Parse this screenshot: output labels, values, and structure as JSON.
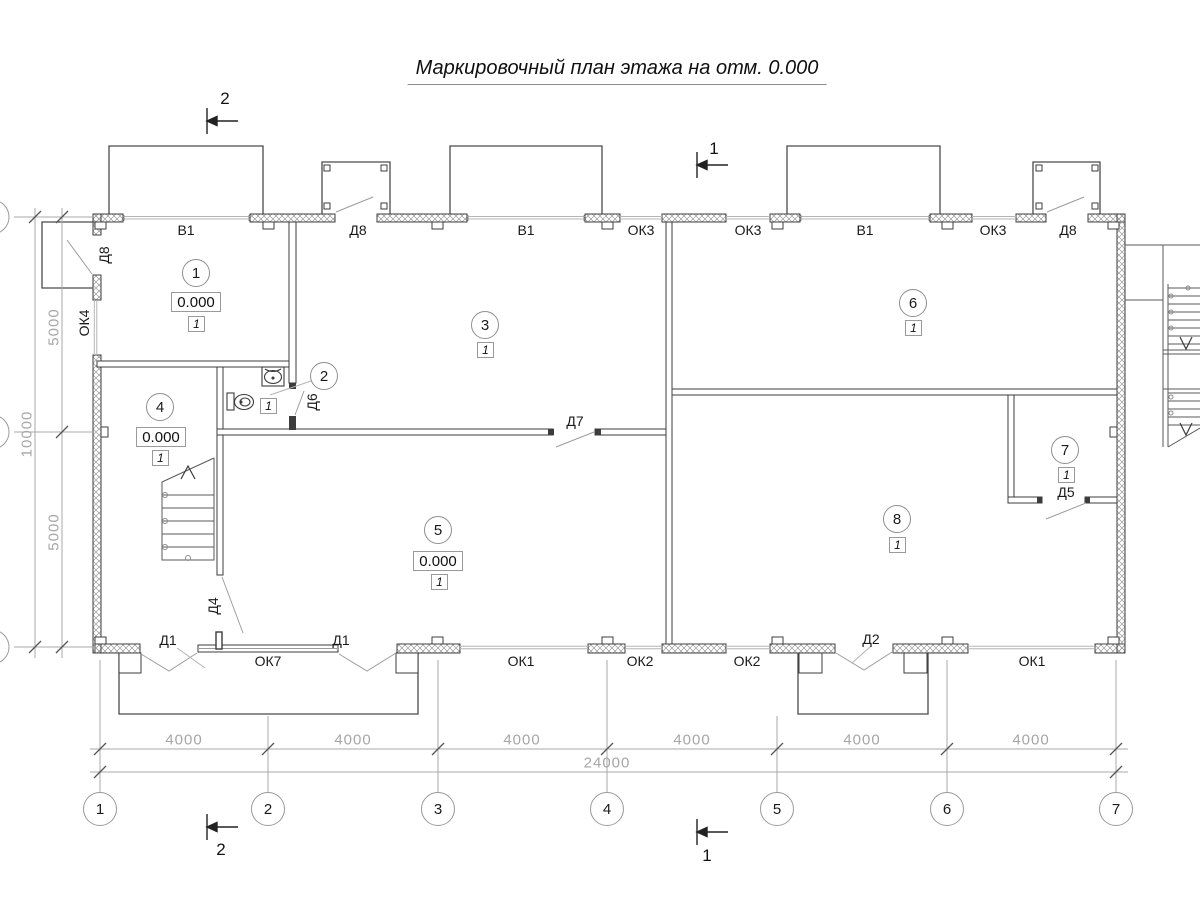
{
  "title": "Маркировочный план этажа на отм. 0.000",
  "labels": {
    "v1": "В1",
    "d8": "Д8",
    "ok3": "ОК3",
    "ok4": "ОК4",
    "d1": "Д1",
    "d2": "Д2",
    "d4": "Д4",
    "d5": "Д5",
    "d6": "Д6",
    "d7": "Д7",
    "ok1": "ОК1",
    "ok2": "ОК2",
    "ok7": "ОК7"
  },
  "rooms": {
    "r1": {
      "number": "1",
      "elevation": "0.000",
      "finish": "1"
    },
    "r2": {
      "number": "2",
      "finish": "1"
    },
    "r3": {
      "number": "3",
      "finish": "1"
    },
    "r4": {
      "number": "4",
      "elevation": "0.000",
      "finish": "1"
    },
    "r5": {
      "number": "5",
      "elevation": "0.000",
      "finish": "1"
    },
    "r6": {
      "number": "6",
      "finish": "1"
    },
    "r7": {
      "number": "7",
      "finish": "1"
    },
    "r8": {
      "number": "8",
      "finish": "1"
    }
  },
  "axes": {
    "labels": [
      "1",
      "2",
      "3",
      "4",
      "5",
      "6",
      "7"
    ]
  },
  "dimensions": {
    "bay": "4000",
    "total": "24000",
    "half": "5000",
    "side_total": "10000"
  },
  "sections": {
    "s1": "1",
    "s2": "2"
  },
  "colors": {
    "line": "#3c3c3c",
    "dim_text": "#a6a6a6",
    "dim_line": "#a8a8a8"
  }
}
